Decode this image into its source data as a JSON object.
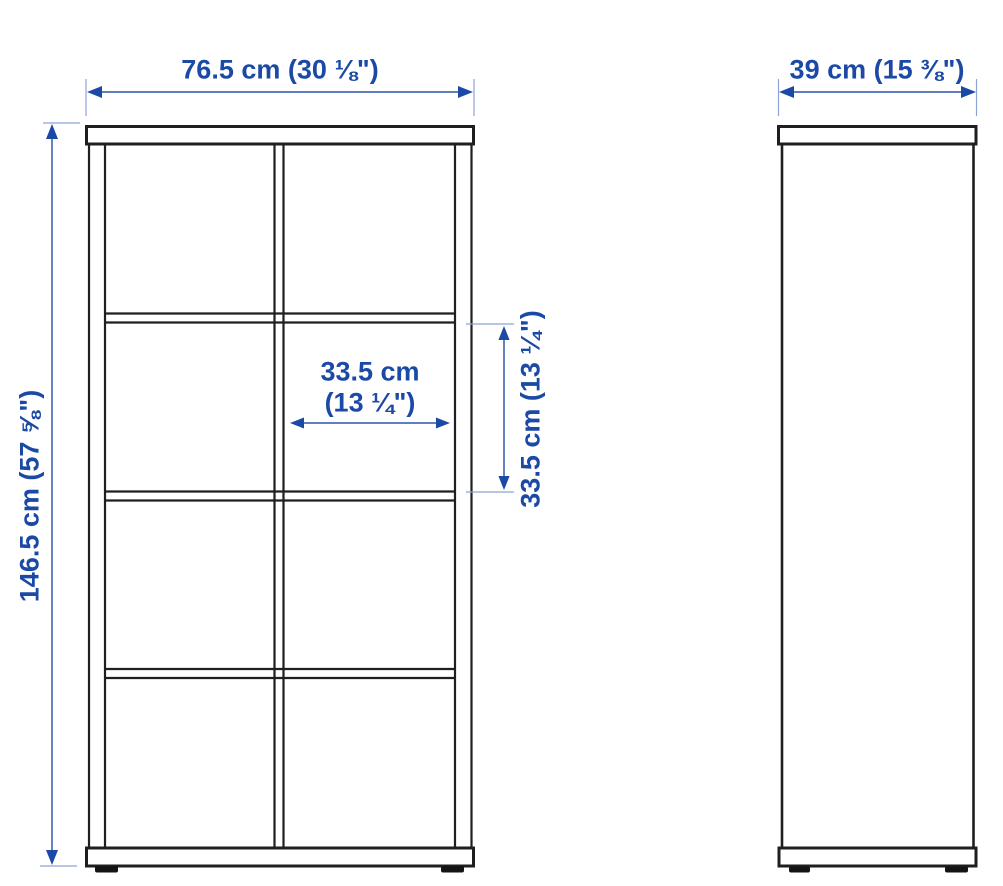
{
  "diagram": {
    "labels": {
      "overall_width": "76.5 cm (30 ⅛\")",
      "depth": "39 cm (15 ⅜\")",
      "overall_height": "146.5 cm (57 ⅝\")",
      "compartment_width_line1": "33.5 cm",
      "compartment_width_line2": "(13 ¼\")",
      "compartment_height": "33.5 cm (13 ¼\")"
    },
    "values": {
      "overall_width_cm": 76.5,
      "overall_width_in": "30 ⅛",
      "depth_cm": 39,
      "depth_in": "15 ⅜",
      "overall_height_cm": 146.5,
      "overall_height_in": "57 ⅝",
      "compartment_width_cm": 33.5,
      "compartment_width_in": "13 ¼",
      "compartment_height_cm": 33.5,
      "compartment_height_in": "13 ¼"
    },
    "structure": {
      "front_view_grid": "2 columns x 4 rows of open compartments",
      "views": [
        "front elevation",
        "side elevation"
      ]
    },
    "colors": {
      "dimension_text_blue": "#1b49a6",
      "dimension_line_blue": "#4a6cba",
      "dimension_tick_blue": "#8fa2d8",
      "outline_black": "#1f1f21",
      "background": "#ffffff"
    }
  }
}
